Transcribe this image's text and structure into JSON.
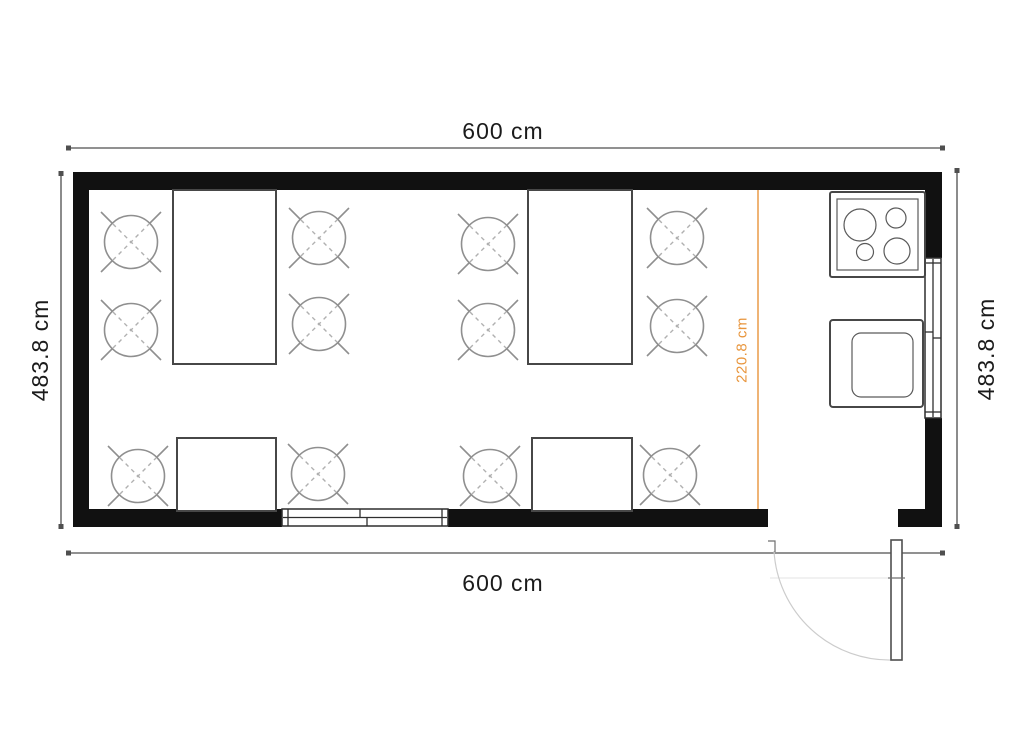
{
  "plan": {
    "type": "floor-plan",
    "room": "dining room with kitchenette",
    "furniture": {
      "large_dining_tables": 2,
      "small_dining_tables": 2,
      "chairs": 12,
      "cooktop_burners": 4,
      "ovens": 1,
      "windows": 2,
      "doors": 1
    }
  },
  "dimensions": {
    "width_top": "600 cm",
    "width_bottom": "600 cm",
    "height_left": "483.8 cm",
    "height_right": "483.8 cm",
    "kitchen_depth": "220.8 cm"
  },
  "colors": {
    "wall": "#111111",
    "dimension_line": "#4f4f4f",
    "dimension_text": "#1b1b1b",
    "accent_orange": "#E8953C",
    "furniture_stroke": "#474747",
    "chair_stroke": "#8f8f8f",
    "door_arc": "#cccccc",
    "background": "#ffffff"
  }
}
